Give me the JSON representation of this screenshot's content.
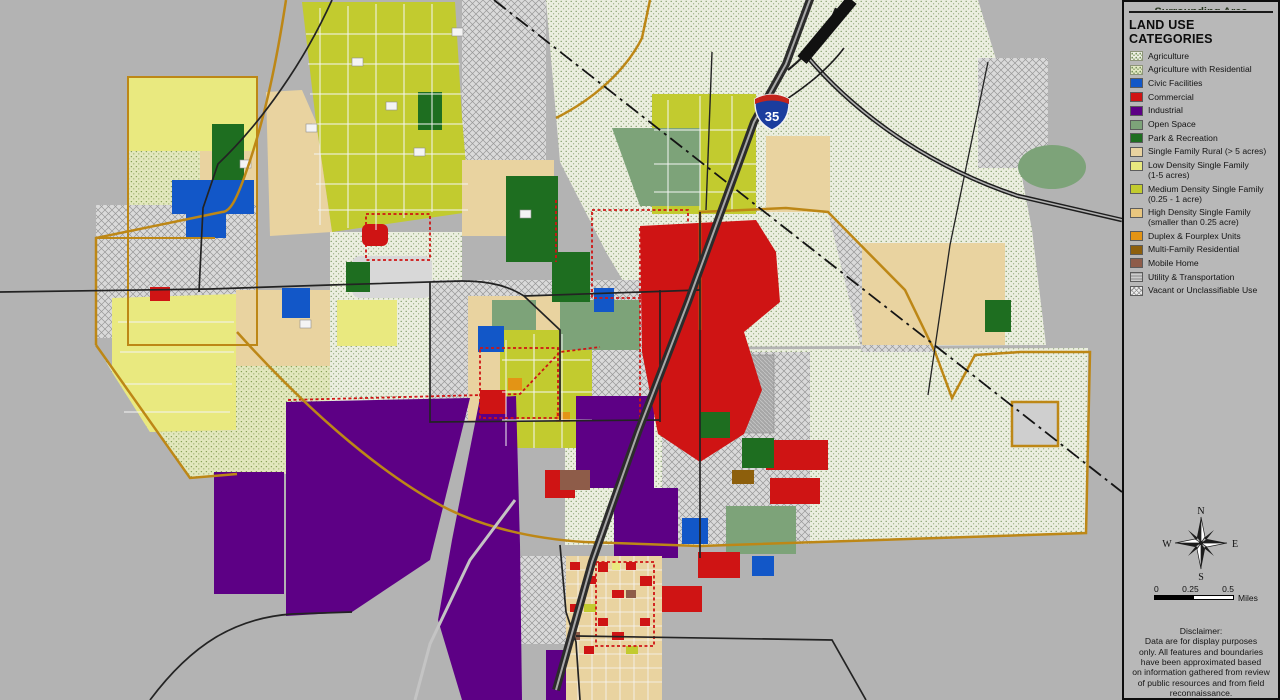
{
  "panel": {
    "clipped_header": "Surrounding Area",
    "title": "LAND USE CATEGORIES",
    "items": [
      {
        "label": "Agriculture",
        "color": "#eef0e4",
        "pattern": "dots"
      },
      {
        "label": "Agriculture with Residential",
        "color": "#e4e9c4",
        "pattern": "dots"
      },
      {
        "label": "Civic Facilities",
        "color": "#1257c8"
      },
      {
        "label": "Commercial",
        "color": "#cf1414"
      },
      {
        "label": "Industrial",
        "color": "#5d0085"
      },
      {
        "label": "Open Space",
        "color": "#7da379"
      },
      {
        "label": "Park & Recreation",
        "color": "#1e6e20"
      },
      {
        "label": "Single Family Rural (> 5 acres)",
        "color": "#e9d3a0"
      },
      {
        "label": "Low Density Single Family",
        "sublabel": "(1-5 acres)",
        "color": "#e9e97f"
      },
      {
        "label": "Medium Density Single Family",
        "sublabel": "(0.25 - 1 acre)",
        "color": "#c2cb2f"
      },
      {
        "label": "High Density Single Family",
        "sublabel": "(smaller than 0.25 acre)",
        "color": "#e8c67f"
      },
      {
        "label": "Duplex & Fourplex Units",
        "color": "#e39415"
      },
      {
        "label": "Multi-Family Residential",
        "color": "#8d5f0c"
      },
      {
        "label": "Mobile Home",
        "color": "#8e5c49"
      },
      {
        "label": "Utility & Transportation",
        "color": "#ababab",
        "pattern": "util"
      },
      {
        "label": "Vacant or Unclassifiable Use",
        "color": "#ececec",
        "pattern": "cross"
      }
    ]
  },
  "compass": {
    "north": "N",
    "south": "S",
    "east": "E",
    "west": "W"
  },
  "scalebar": {
    "tick0": "0",
    "tick1": "0.25",
    "tick2": "0.5",
    "unit": "Miles"
  },
  "disclaimer": "Disclaimer:\nData are for display purposes\nonly.  All features and boundaries\nhave been approximated based\non information gathered from review\nof public resources and from field\nreconnaissance.",
  "map": {
    "highway_shield": "35",
    "background_color": "#b3b3b3",
    "boundary_color": "#bd8716"
  }
}
